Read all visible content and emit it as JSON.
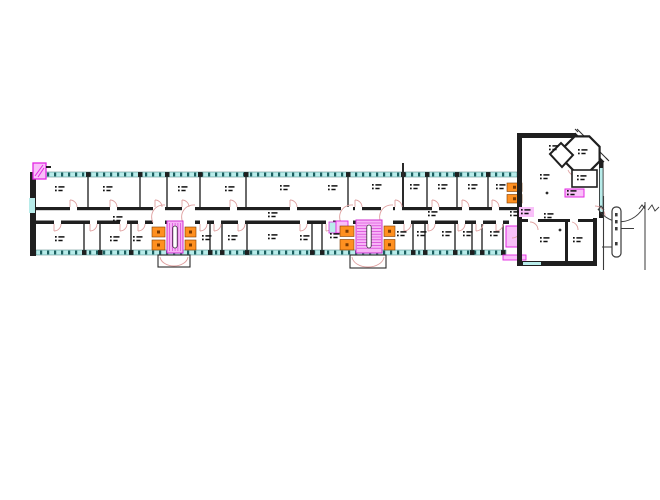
{
  "palette": {
    "wall": "#1f1f1f",
    "partition": "#2a2a2a",
    "window_fill": "#b8ecea",
    "window_tick": "#1c5f5f",
    "door": "#dfa0a0",
    "stair_fill": "#f7b4f7",
    "stair_line": "#cf2fcf",
    "stair_rail": "#ffffff",
    "shaft_fill": "#ff9020",
    "shaft_mark": "#7c3a00",
    "magenta": "#e228e2",
    "magenta_fill": "#f9c0f9",
    "road": "#3a3a3a",
    "label": "#111111"
  },
  "wing": {
    "x1": 30,
    "x2": 517,
    "top_y": 172,
    "bottom_y": 250,
    "band_h": 5,
    "left_wall": {
      "x": 30,
      "w": 6,
      "y1": 172,
      "y2": 256,
      "window_y1": 198,
      "window_y2": 213
    },
    "band_top": {
      "x1": 36,
      "x2": 517
    },
    "band_bottom": {
      "x1": 36,
      "x2": 506
    },
    "tick_step": 7,
    "corridor": {
      "x1": 36,
      "x2": 522,
      "top_y": 207,
      "top_h": 3.2,
      "bot_y": 220.5,
      "bot_h": 3.5
    },
    "rooms_top": {
      "y1": 177,
      "y2": 207,
      "partitions": [
        88,
        140,
        167,
        200,
        246,
        348,
        403,
        427,
        457,
        488
      ]
    },
    "rooms_bottom": {
      "y1": 224,
      "y2": 250,
      "partitions": [
        84,
        100,
        131,
        210,
        222,
        247,
        312,
        322,
        413,
        425,
        455,
        472,
        482,
        503
      ]
    },
    "doors_top": [
      70,
      110,
      155,
      182,
      230,
      290,
      355,
      395,
      432,
      462,
      492
    ],
    "doors_bottom": [
      54,
      90,
      120,
      138,
      200,
      214,
      238,
      300,
      326,
      404,
      428,
      458,
      476,
      496
    ],
    "core_gaps": [
      [
        153,
        165
      ],
      [
        183,
        195
      ],
      [
        341,
        353
      ],
      [
        381,
        393
      ]
    ]
  },
  "cores": [
    {
      "shaft_l": {
        "x": 152,
        "y": 227,
        "w": 13,
        "h": 23
      },
      "stair": {
        "x": 167,
        "y": 221,
        "w": 16,
        "h": 32,
        "treads": "v"
      },
      "shaft_r": {
        "x": 185,
        "y": 227,
        "w": 11,
        "h": 23
      },
      "porch": {
        "x": 158,
        "y": 255,
        "w": 32,
        "h": 12
      }
    },
    {
      "shaft_l": {
        "x": 340,
        "y": 226,
        "w": 14,
        "h": 24
      },
      "stair": {
        "x": 356,
        "y": 220,
        "w": 26,
        "h": 33,
        "treads": "h"
      },
      "shaft_r": {
        "x": 384,
        "y": 226,
        "w": 11,
        "h": 24
      },
      "porch": {
        "x": 350,
        "y": 255,
        "w": 36,
        "h": 13
      },
      "lift_cyan": {
        "x": 329,
        "y": 222,
        "w": 7,
        "h": 11
      },
      "lift_mag": {
        "x": 336,
        "y": 221,
        "w": 12,
        "h": 12
      }
    }
  ],
  "junction": {
    "shaft": {
      "x": 507,
      "y": 183,
      "w": 15,
      "h": 20
    },
    "mag_room": {
      "x": 506,
      "y": 226,
      "w": 15,
      "h": 21
    },
    "strip": {
      "x": 503,
      "y": 255,
      "w": 23,
      "h": 5
    }
  },
  "head": {
    "left_wall": {
      "x": 517,
      "w": 5,
      "y1": 133,
      "y2": 266
    },
    "top_wall": {
      "x1": 517,
      "x2": 576,
      "y": 133,
      "h": 5
    },
    "chamfer": {
      "x1": 574,
      "y1": 134,
      "x2": 603,
      "y2": 163
    },
    "right_wall": {
      "x": 599,
      "w": 4.5,
      "y1": 161,
      "y2": 218,
      "window_y1": 168,
      "window_y2": 212
    },
    "step_wall": {
      "x": 593,
      "w": 4,
      "y1": 218,
      "y2": 266
    },
    "bottom_wall": {
      "x1": 517,
      "x2": 597,
      "y": 261,
      "h": 5,
      "window_x1": 523,
      "window_x2": 541
    },
    "interior_h": {
      "x1": 522,
      "x2": 593,
      "y": 219,
      "h": 3,
      "door_gaps": [
        [
          528,
          538
        ],
        [
          570,
          578
        ]
      ]
    },
    "interior_v": {
      "x": 565,
      "w": 3,
      "y1": 222,
      "y2": 261
    },
    "octagon": {
      "cx": 582,
      "cy": 154,
      "r": 19
    },
    "angled_room": [
      [
        550,
        154
      ],
      [
        561,
        143
      ],
      [
        573,
        155
      ],
      [
        562,
        167
      ]
    ],
    "small_room": {
      "x": 572,
      "y": 170,
      "w": 25,
      "h": 17
    },
    "mag_box": {
      "x": 565,
      "y": 189,
      "w": 19,
      "h": 8
    },
    "entrance": {
      "x": 593,
      "y1": 206,
      "y2": 216
    },
    "columns": [
      [
        547,
        193
      ],
      [
        560,
        230
      ]
    ]
  },
  "road": {
    "v1": {
      "x": 603.5,
      "y1": 196,
      "y2": 270
    },
    "v2": {
      "x": 645,
      "y1": 202,
      "y2": 270
    },
    "arc": "M 598 209 C 610 227 634 226 645 205",
    "island": {
      "x": 612,
      "y": 207,
      "w": 9,
      "h": 50,
      "marks": [
        213,
        220,
        227,
        242
      ]
    },
    "tick_right": {
      "x1": 621,
      "x2": 634,
      "y": 228.5
    },
    "tick_left": {
      "x1": 602,
      "x2": 612,
      "y": 247
    },
    "chevrons": [
      [
        601,
        206
      ],
      [
        642,
        205
      ]
    ],
    "zigzag": "648,210 652,205 655,211 659,207"
  },
  "marker": {
    "x": 33,
    "y": 163,
    "w": 13,
    "h": 16,
    "tick": [
      46,
      167,
      51,
      167
    ]
  },
  "labels": {
    "top": [
      [
        55,
        186
      ],
      [
        103,
        186
      ],
      [
        178,
        186
      ],
      [
        225,
        186
      ],
      [
        280,
        185
      ],
      [
        328,
        185
      ],
      [
        372,
        184
      ],
      [
        410,
        184
      ],
      [
        438,
        184
      ],
      [
        468,
        184
      ],
      [
        496,
        184
      ]
    ],
    "bottom": [
      [
        55,
        236
      ],
      [
        110,
        236
      ],
      [
        133,
        236
      ],
      [
        202,
        235
      ],
      [
        228,
        235
      ],
      [
        268,
        234
      ],
      [
        300,
        235
      ],
      [
        330,
        233
      ],
      [
        397,
        231
      ],
      [
        417,
        231
      ],
      [
        442,
        231
      ],
      [
        463,
        231
      ],
      [
        490,
        231
      ]
    ],
    "corridor": [
      [
        113,
        216
      ],
      [
        268,
        212
      ],
      [
        428,
        211
      ],
      [
        510,
        211
      ]
    ],
    "head": [
      [
        549,
        145
      ],
      [
        578,
        149
      ],
      [
        540,
        174
      ],
      [
        577,
        175
      ],
      [
        544,
        213
      ],
      [
        540,
        237
      ],
      [
        573,
        237
      ]
    ],
    "magenta_tinted": [
      [
        521,
        209
      ]
    ],
    "on_magenta_box": [
      [
        567,
        190
      ]
    ]
  }
}
